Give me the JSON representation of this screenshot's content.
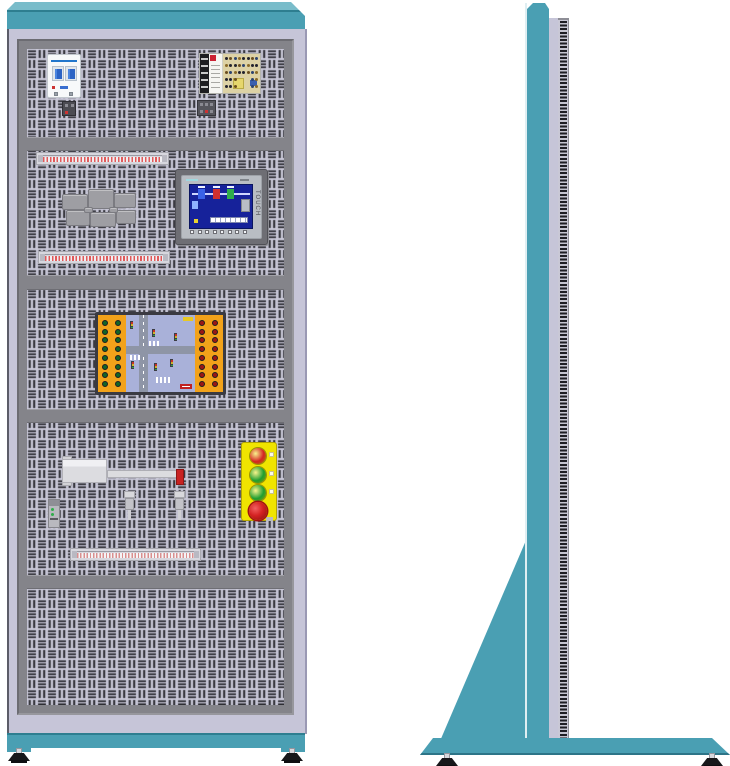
{
  "colors": {
    "teal": "#4a9fb3",
    "teal_light": "#79bcca",
    "teal_dark": "#2e7e90",
    "lavender_frame": "#c6c5d8",
    "panel_background": "#c9c8d8",
    "panel_slot": "#26262c",
    "frame_gray": "#84848a",
    "module_orange": "#f2a21a",
    "station_yellow": "#f0e400",
    "button_red": "#d42222",
    "button_green": "#1f9e30",
    "screen_blue": "#16229a",
    "breaker_blue": "#2b63c4",
    "psu_logo_red": "#cc2233",
    "rod_tip_red": "#c82222"
  },
  "hmi": {
    "touch_label": "TOUCH",
    "screen_tank_colors": [
      "#3a62e8",
      "#d03030",
      "#2fae4a"
    ],
    "key_count": 8
  },
  "button_station": {
    "buttons": [
      {
        "name": "push-button-red",
        "color_key": "button_red",
        "estop": false
      },
      {
        "name": "push-button-green-1",
        "color_key": "button_green",
        "estop": false
      },
      {
        "name": "push-button-green-2",
        "color_key": "button_green",
        "estop": false
      },
      {
        "name": "emergency-stop-button",
        "color_key": "button_red",
        "estop": true
      }
    ]
  },
  "traffic_module": {
    "left_jack_color": "#136428",
    "right_jack_color": "#9a1616",
    "jack_rows": 8,
    "jack_cols": 2
  },
  "breaker": {
    "pole_count": 2
  },
  "feet": {
    "front_count": 2,
    "side_count": 2
  }
}
